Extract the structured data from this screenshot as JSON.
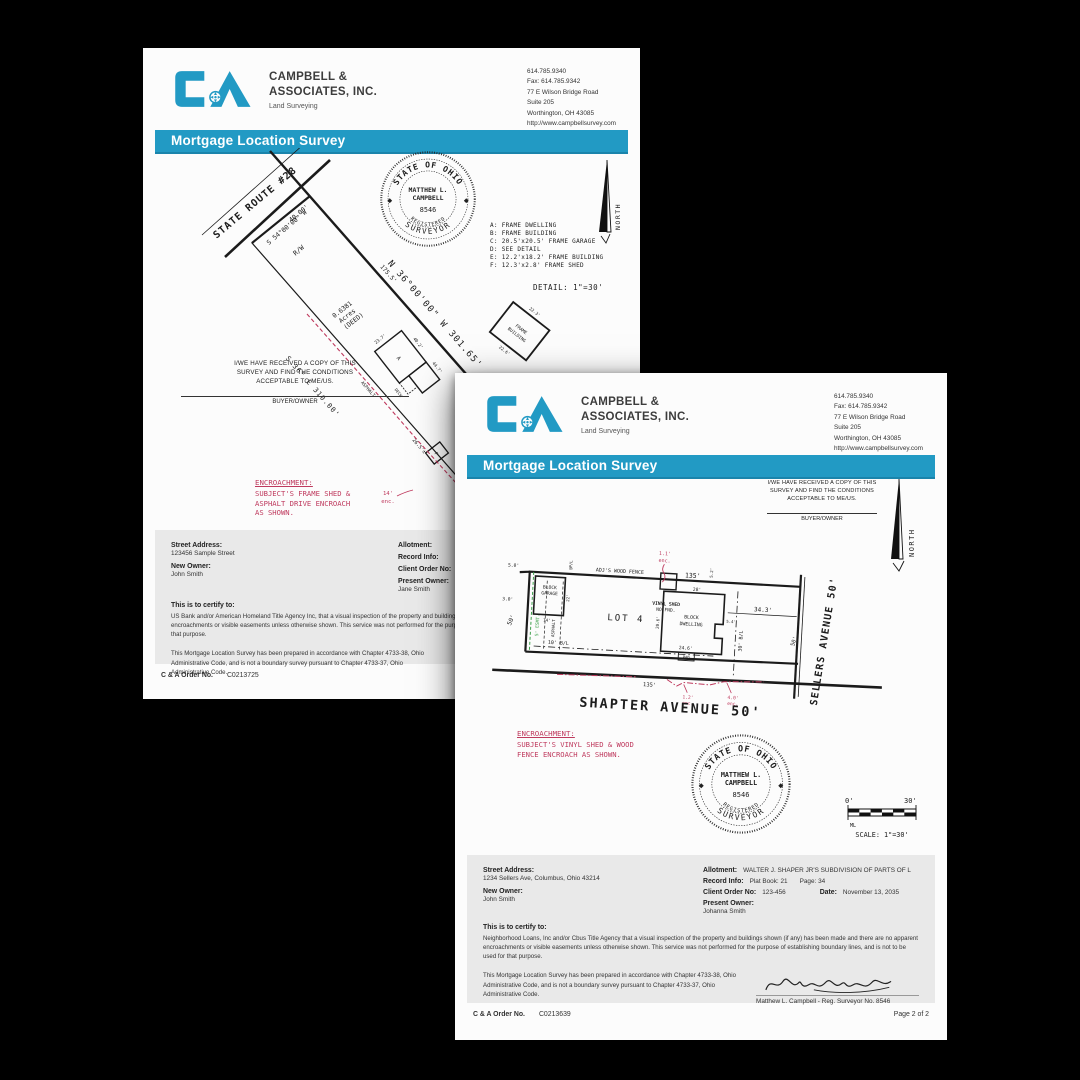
{
  "colors": {
    "brand_blue": "#229ac4",
    "accent_red": "#bf3a5e",
    "easement_green": "#3da04b"
  },
  "header": {
    "company1": "CAMPBELL &",
    "company2": "ASSOCIATES, INC.",
    "tagline": "Land Surveying",
    "banner": "Mortgage Location Survey",
    "contact": [
      "614.785.9340",
      "Fax: 614.785.9342",
      "77 E Wilson Bridge Road",
      "Suite 205",
      "Worthington, OH 43085",
      "http://www.campbellsurvey.com"
    ]
  },
  "receipt": {
    "line1": "I/WE HAVE RECEIVED A COPY OF THIS",
    "line2": "SURVEY AND FIND THE CONDITIONS",
    "line3": "ACCEPTABLE TO ME/US.",
    "signee": "BUYER/OWNER"
  },
  "seal": {
    "arc_top": "STATE OF OHIO",
    "name1": "MATTHEW L.",
    "name2": "CAMPBELL",
    "number": "8546",
    "reg": "REGISTERED",
    "surveyor": "SURVEYOR"
  },
  "north": "NORTH",
  "p1": {
    "survey": {
      "road": "STATE ROUTE #28",
      "dim_40": "40.00'",
      "bearing_front": "S 54°00'00\" W",
      "rw": "R/W",
      "dim_1755": "175.5'",
      "bearing_ne": "N 36°00'00\" W 301.65'",
      "acres1": "0.6381",
      "acres2": "Acres",
      "acres3": "(DEED)",
      "bearing_sw": "S 36° E 310.00'",
      "asphalt": "ASPHALT",
      "dim_265": "26.5'±",
      "dim_402": "40.2'",
      "dim_447": "44.7'",
      "dim_237": "23.7'",
      "bldg_a": "A",
      "deck": "DECK",
      "shed_f": "F",
      "enc1": "14'",
      "enc2": "enc.",
      "legend": [
        "A: FRAME DWELLING",
        "B: FRAME BUILDING",
        "C: 20.5'x20.5' FRAME GARAGE",
        "D: SEE DETAIL",
        "E: 12.2'x18.2' FRAME BUILDING",
        "F: 12.3'x2.8' FRAME SHED"
      ],
      "detail_title": "DETAIL: 1\"=30'",
      "detail1": "FRAME",
      "detail2": "BUILDING",
      "detail_dim_top": "22.3'",
      "detail_dim_bottom": "22.6'"
    },
    "encroachment": {
      "title": "ENCROACHMENT:",
      "line2": "SUBJECT'S FRAME SHED &",
      "line3": "ASPHALT DRIVE ENCROACH",
      "line4": "AS SHOWN."
    },
    "info": {
      "street_label": "Street Address:",
      "street": "123456 Sample Street",
      "owner_label": "New Owner:",
      "owner": "John Smith",
      "allotment_label": "Allotment:",
      "record_label": "Record Info:",
      "client_label": "Client Order No:",
      "present_label": "Present Owner:",
      "present": "Jane Smith",
      "certify_label": "This is to certify to:",
      "certify_text": "US Bank and/or American Homeland Title Agency Inc, that a visual inspection of the property and buildings shown (if any) has been made and there are no apparent encroachments or visible easements unless otherwise shown. This service was not performed for the purpose of establishing boundary lines, and is not to be used for that purpose.",
      "prepared_text": "This Mortgage Location Survey has been prepared in accordance with Chapter 4733-38, Ohio Administrative Code, and is not a boundary survey pursuant to Chapter 4733-37, Ohio Administrative Code.",
      "surveyor_line": "Matthew L. Campbell - Reg. Surveyor No. 8546",
      "order_label": "C & A Order No.",
      "order_no": "C0213725"
    }
  },
  "p2": {
    "survey": {
      "lot": "LOT 4",
      "garage1": "BLOCK",
      "garage2": "GARAGE",
      "dim_22": "22'",
      "dim_14": "14'",
      "ppl": "@P/L",
      "dim_50tl": "5.0'",
      "dim_30l": "3.0'",
      "dim_50l": "50'",
      "esmt": "5' ESMT.",
      "asphalt": "ASPHALT",
      "fence": "ADJ'S WOOD FENCE",
      "dim_135_top": "135'",
      "enc_t1": "1.1'",
      "enc_t2": "enc.",
      "shed1": "VINYL SHED",
      "shed2": "NO FND.",
      "dim_52": "5.2'",
      "dwelling1": "BLOCK",
      "dwelling2": "DWELLING",
      "dim_28": "28'",
      "dim_246": "24.6'",
      "dim_206": "20.6'",
      "dim_54": "5.4'",
      "pad": "PAD",
      "dim_343": "34.3'",
      "bl30": "30' B/L",
      "bl10": "10' B/L",
      "dim_135_b": "135'",
      "enc_b1": "1.2'",
      "enc_b2": "enc.",
      "enc_b3": "4.0'",
      "enc_b4": "enc.",
      "street_bottom": "SHAPTER AVENUE 50'",
      "street_right": "SELLERS AVENUE 50'",
      "dim_50r": "50'"
    },
    "encroachment": {
      "title": "ENCROACHMENT:",
      "line2": "SUBJECT'S VINYL SHED & WOOD",
      "line3": "FENCE ENCROACH AS SHOWN."
    },
    "scale": {
      "zero": "0'",
      "thirty": "30'",
      "ml": "ML",
      "label": "SCALE: 1\"=30'"
    },
    "info": {
      "street_label": "Street Address:",
      "street": "1234 Sellers Ave, Columbus, Ohio 43214",
      "owner_label": "New Owner:",
      "owner": "John Smith",
      "allotment_label": "Allotment:",
      "allotment": "WALTER J. SHAPER JR'S SUBDIVISION OF PARTS OF L",
      "record_label": "Record Info:",
      "record1": "Plat Book: 21",
      "record2": "Page: 34",
      "client_label": "Client Order No:",
      "client": "123-456",
      "date_label": "Date:",
      "date": "November 13, 2035",
      "present_label": "Present Owner:",
      "present": "Johanna Smith",
      "certify_label": "This is to certify to:",
      "certify_text": "Neighborhood Loans, Inc and/or Cbus Title Agency that a visual inspection of the property and buildings shown (if any) has been made and there are no apparent encroachments or visible easements unless otherwise shown. This service was not performed for the purpose of establishing boundary lines, and is not to be used for that purpose.",
      "prepared_text": "This Mortgage Location Survey has been prepared in accordance with Chapter 4733-38, Ohio Administrative Code, and is not a boundary survey pursuant to Chapter 4733-37, Ohio Administrative Code.",
      "surveyor_line": "Matthew L. Campbell - Reg. Surveyor No. 8546",
      "order_label": "C & A Order No.",
      "order_no": "C0213639",
      "page_label": "Page 2 of 2"
    }
  }
}
